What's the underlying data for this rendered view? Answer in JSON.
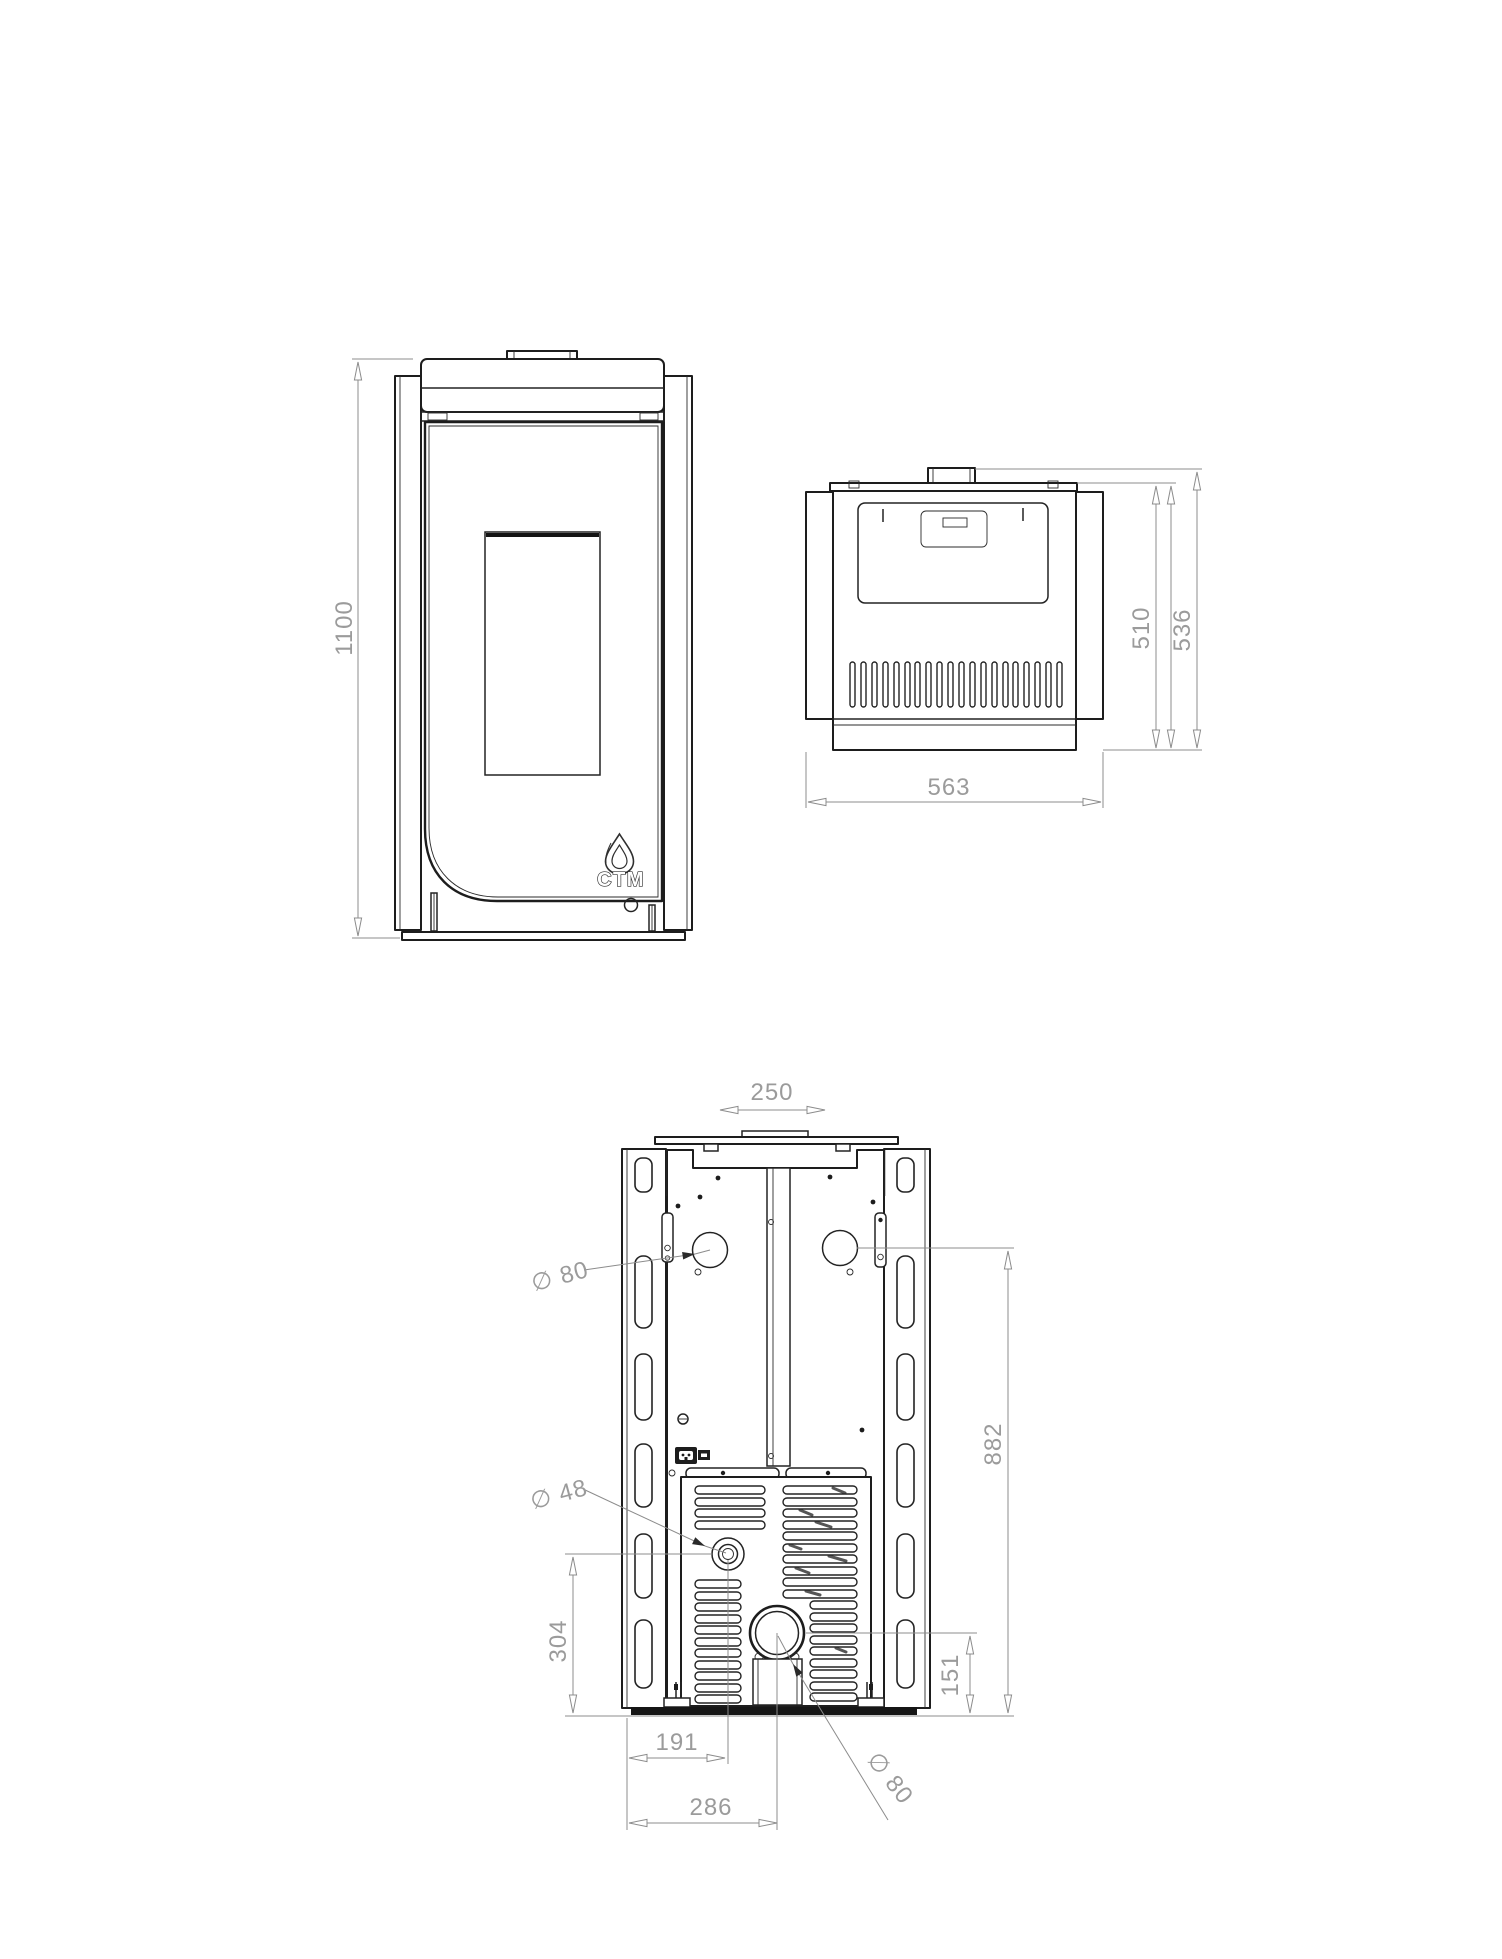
{
  "page": {
    "background": "#ffffff"
  },
  "colors": {
    "line": "#1d1d1d",
    "dimension_line": "#8c8c8c",
    "dimension_text": "#9b9b9b"
  },
  "drawing": {
    "brand": {
      "logo_text": "CTM",
      "logo_icon": "flame-icon"
    },
    "front_view": {
      "height": "1100"
    },
    "top_view": {
      "width": "563",
      "depth_body": "510",
      "depth_total": "536"
    },
    "rear_view": {
      "flue_collar_width": "250",
      "smoke_outlet_diameter": "∅ 80",
      "outlet_height": "882",
      "water_fitting_diameter": "∅ 48",
      "water_fitting_height": "304",
      "flue_height": "151",
      "water_fitting_offset": "191",
      "flue_offset": "286",
      "flue_diameter": "∅ 80"
    }
  }
}
